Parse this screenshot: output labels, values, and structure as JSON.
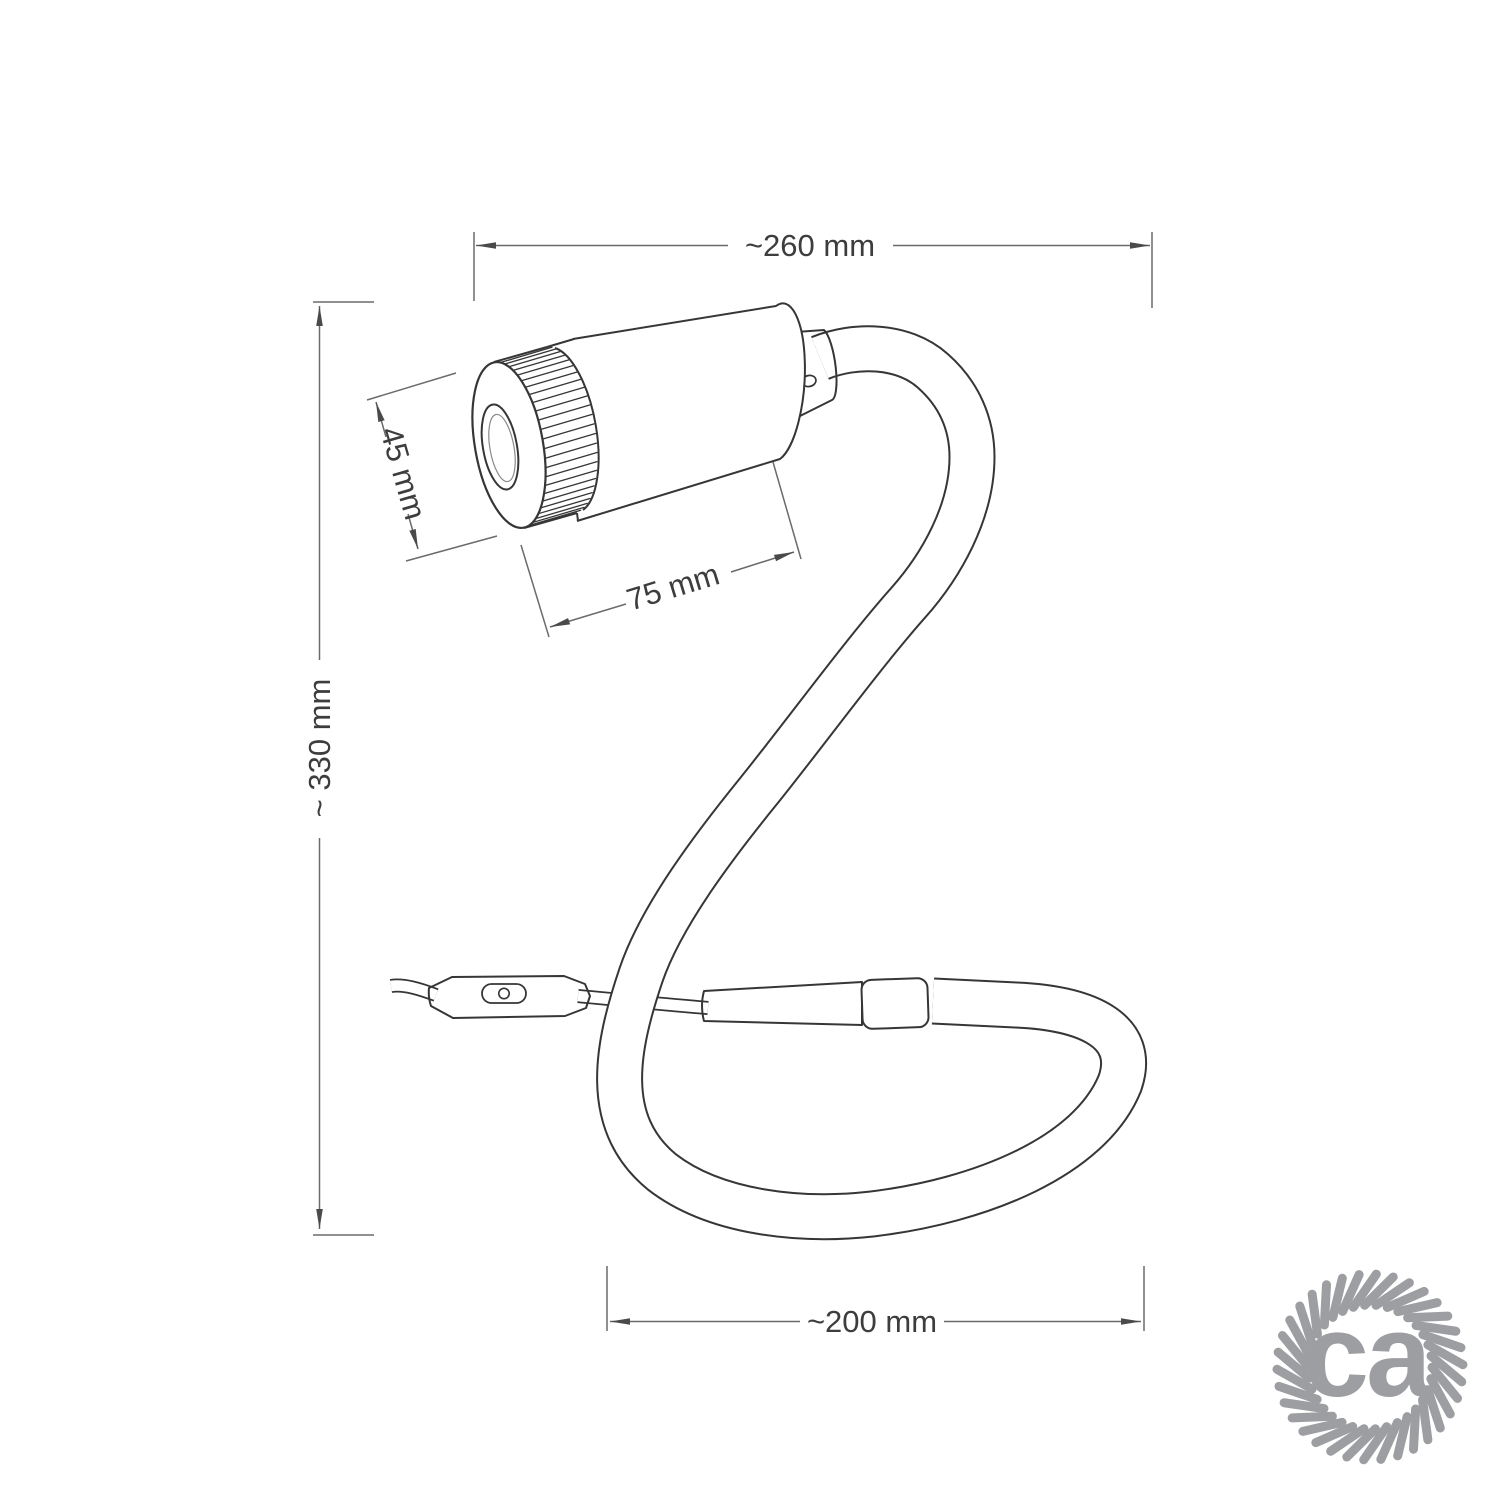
{
  "diagram": {
    "dim_top_label": "~260 mm",
    "dim_left_label": "~ 330 mm",
    "dim_lens_label": "45 mm",
    "dim_head_label": "75 mm",
    "dim_bottom_label": "~200 mm"
  },
  "logo": {
    "text": "ca",
    "color": "#9d9ea1"
  },
  "style": {
    "line_color": "#363636",
    "dim_line_color": "#6b6b6b",
    "text_color": "#3d3d3d"
  }
}
